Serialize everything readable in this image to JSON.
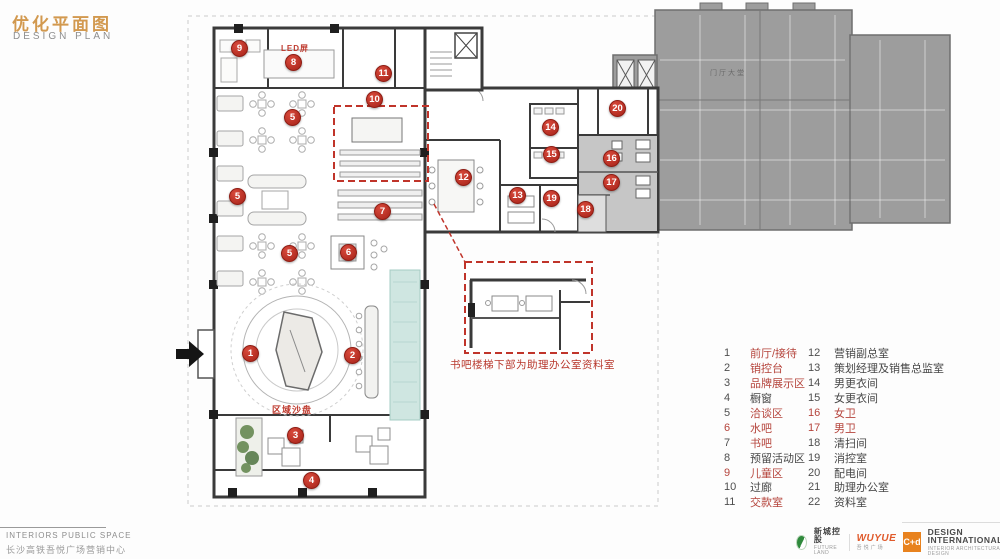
{
  "header": {
    "title": "优化平面图",
    "subtitle": "DESIGN PLAN"
  },
  "plan": {
    "markers": [
      "1",
      "2",
      "3",
      "4",
      "5",
      "5",
      "5",
      "6",
      "7",
      "8",
      "9",
      "10",
      "11",
      "12",
      "13",
      "14",
      "15",
      "16",
      "17",
      "18",
      "19",
      "20"
    ],
    "labels": {
      "led": "LED屏",
      "sandtable": "区域沙盘",
      "lobby": "门厅大堂"
    },
    "inset_caption": "书吧楼梯下部为助理办公室资料室"
  },
  "legend": {
    "items": [
      {
        "num": "1",
        "label": "前厅/接待",
        "red_num": false,
        "red_label": true
      },
      {
        "num": "2",
        "label": "销控台",
        "red_num": false,
        "red_label": true
      },
      {
        "num": "3",
        "label": "品牌展示区",
        "red_num": false,
        "red_label": true
      },
      {
        "num": "4",
        "label": "橱窗",
        "red_num": false,
        "red_label": false
      },
      {
        "num": "5",
        "label": "洽谈区",
        "red_num": false,
        "red_label": true
      },
      {
        "num": "6",
        "label": "水吧",
        "red_num": true,
        "red_label": true
      },
      {
        "num": "7",
        "label": "书吧",
        "red_num": false,
        "red_label": true
      },
      {
        "num": "8",
        "label": "预留活动区",
        "red_num": false,
        "red_label": false
      },
      {
        "num": "9",
        "label": "儿童区",
        "red_num": true,
        "red_label": true
      },
      {
        "num": "10",
        "label": "过廊",
        "red_num": false,
        "red_label": false
      },
      {
        "num": "11",
        "label": "交款室",
        "red_num": false,
        "red_label": true
      },
      {
        "num": "12",
        "label": "营销副总室",
        "red_num": false,
        "red_label": false
      },
      {
        "num": "13",
        "label": "策划经理及销售总监室",
        "red_num": false,
        "red_label": false
      },
      {
        "num": "14",
        "label": "男更衣间",
        "red_num": false,
        "red_label": false
      },
      {
        "num": "15",
        "label": "女更衣间",
        "red_num": false,
        "red_label": false
      },
      {
        "num": "16",
        "label": "女卫",
        "red_num": true,
        "red_label": true
      },
      {
        "num": "17",
        "label": "男卫",
        "red_num": true,
        "red_label": true
      },
      {
        "num": "18",
        "label": "清扫间",
        "red_num": false,
        "red_label": false
      },
      {
        "num": "19",
        "label": "消控室",
        "red_num": false,
        "red_label": false
      },
      {
        "num": "20",
        "label": "配电间",
        "red_num": false,
        "red_label": false
      },
      {
        "num": "21",
        "label": "助理办公室",
        "red_num": false,
        "red_label": false
      },
      {
        "num": "22",
        "label": "资料室",
        "red_num": false,
        "red_label": false
      }
    ]
  },
  "footer": {
    "label": "INTERIORS PUBLIC SPACE",
    "project": "长沙高铁吾悦广场营销中心"
  },
  "logos": {
    "brand1_cn": "新城控股",
    "brand1_en": "FUTURE LAND",
    "brand2": "WUYUE",
    "brand2_cn": "吾悦广场",
    "brand3_mark": "C+d",
    "brand3_name": "DESIGN INTERNATIONAL",
    "brand3_sub": "INTERIOR ARCHITECTURAL DESIGN"
  }
}
